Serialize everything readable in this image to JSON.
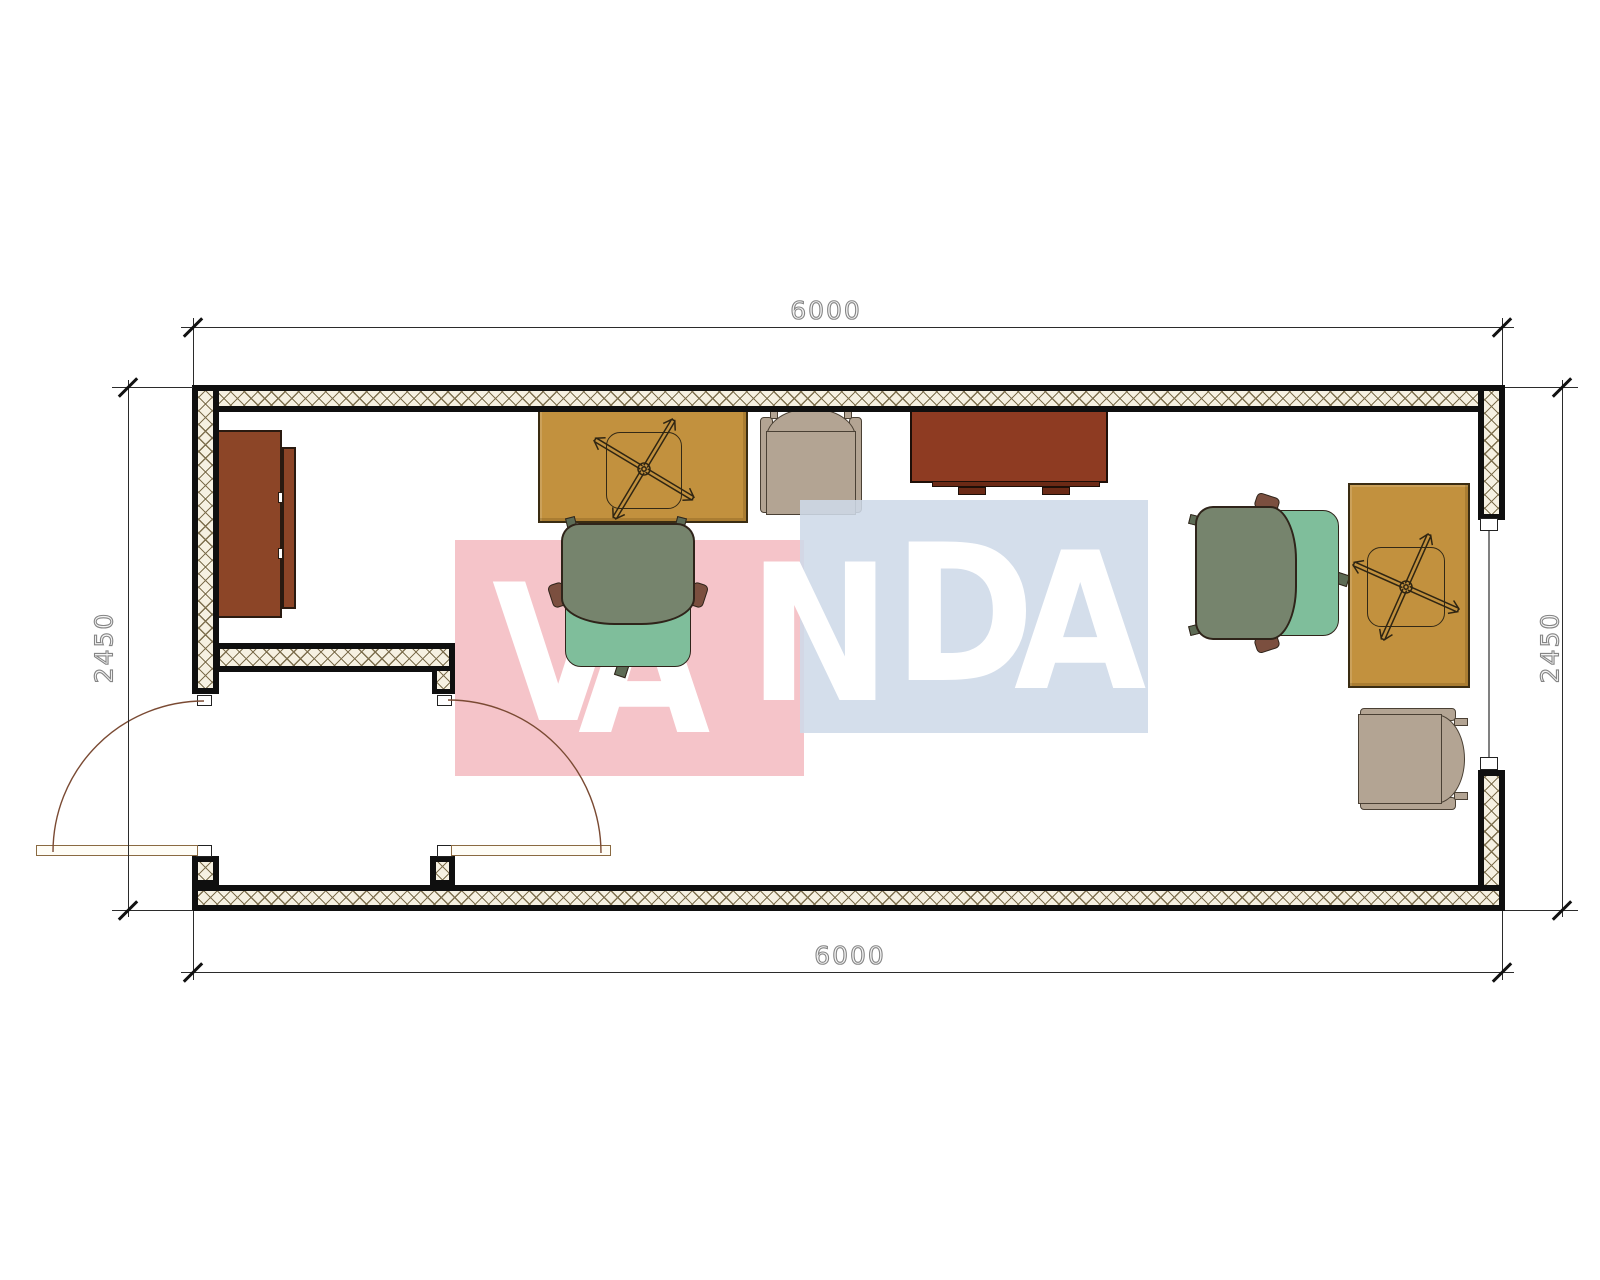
{
  "drawing_type": "floor-plan",
  "dimensions": {
    "top": "6000",
    "bottom": "6000",
    "left": "2450",
    "right": "2450"
  },
  "watermark": {
    "text": "VANDA",
    "letters": [
      "V",
      "A",
      "N",
      "D",
      "A"
    ],
    "pink_block_color": "#F5C4C9",
    "blue_block_color": "#CEDAE8",
    "text_color": "#FFFFFF"
  },
  "palette": {
    "wall_hatch_bg": "#F6F1E2",
    "wall_hatch_line": "#7D6F4E",
    "desk_yellow": "#C2913E",
    "cabinet_brown": "#8C4527",
    "sideboard_brown": "#8E3B22",
    "chair_beige": "#B3A493",
    "chair_green_back": "#76846D",
    "chair_green_seat": "#7FBE9B",
    "door_arc": "#7A4A33",
    "dim_line": "#2B2B2B",
    "dim_text": "#8F8F8F",
    "watermark_pink": "#F5C4C9",
    "watermark_blue": "#CEDAE8",
    "watermark_text": "#FFFFFF"
  },
  "furniture": [
    {
      "name": "wardrobe-cabinet",
      "position": "left-wall"
    },
    {
      "name": "desk-with-swivel-chair-base",
      "position": "top-left"
    },
    {
      "name": "armchair-beige",
      "position": "top-middle"
    },
    {
      "name": "sideboard-brown",
      "position": "top-middle-right"
    },
    {
      "name": "office-chair-green",
      "position": "middle-left"
    },
    {
      "name": "office-chair-green",
      "position": "right"
    },
    {
      "name": "desk-with-swivel-chair-base",
      "position": "right-wall"
    },
    {
      "name": "armchair-beige",
      "position": "bottom-right"
    }
  ],
  "openings": [
    {
      "name": "entry-door-leaf",
      "wall": "left",
      "swing": "outward"
    },
    {
      "name": "interior-door-leaf",
      "wall": "vestibule",
      "swing": "into-room"
    },
    {
      "name": "window",
      "wall": "right"
    }
  ]
}
